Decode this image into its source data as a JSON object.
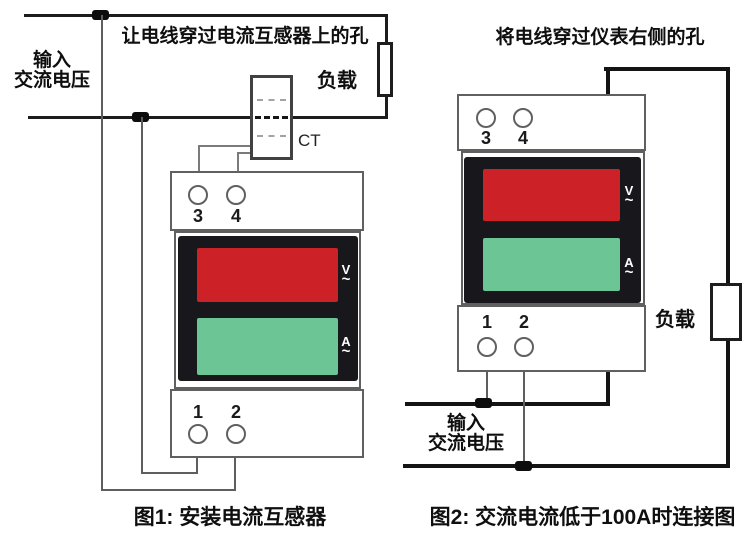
{
  "colors": {
    "display_red": "#cc2127",
    "display_green": "#6cc595",
    "display_bezel": "#18171b",
    "wire_black": "#141414",
    "component_outline": "#606060"
  },
  "figure1": {
    "instruction": "让电线穿过电流互感器上的孔",
    "source_label": {
      "line1": "输入",
      "line2": "交流电压"
    },
    "load_label": "负载",
    "ct_label": "CT",
    "meter": {
      "top_terminals": [
        "3",
        "4"
      ],
      "bottom_terminals": [
        "1",
        "2"
      ],
      "voltage_symbol": "V",
      "current_symbol": "A",
      "ac_symbol": "~"
    },
    "caption": "图1: 安装电流互感器"
  },
  "figure2": {
    "instruction": "将电线穿过仪表右侧的孔",
    "source_label": {
      "line1": "输入",
      "line2": "交流电压"
    },
    "load_label": "负载",
    "meter": {
      "top_terminals": [
        "3",
        "4"
      ],
      "bottom_terminals": [
        "1",
        "2"
      ],
      "voltage_symbol": "V",
      "current_symbol": "A",
      "ac_symbol": "~"
    },
    "caption": "图2: 交流电流低于100A时连接图"
  }
}
